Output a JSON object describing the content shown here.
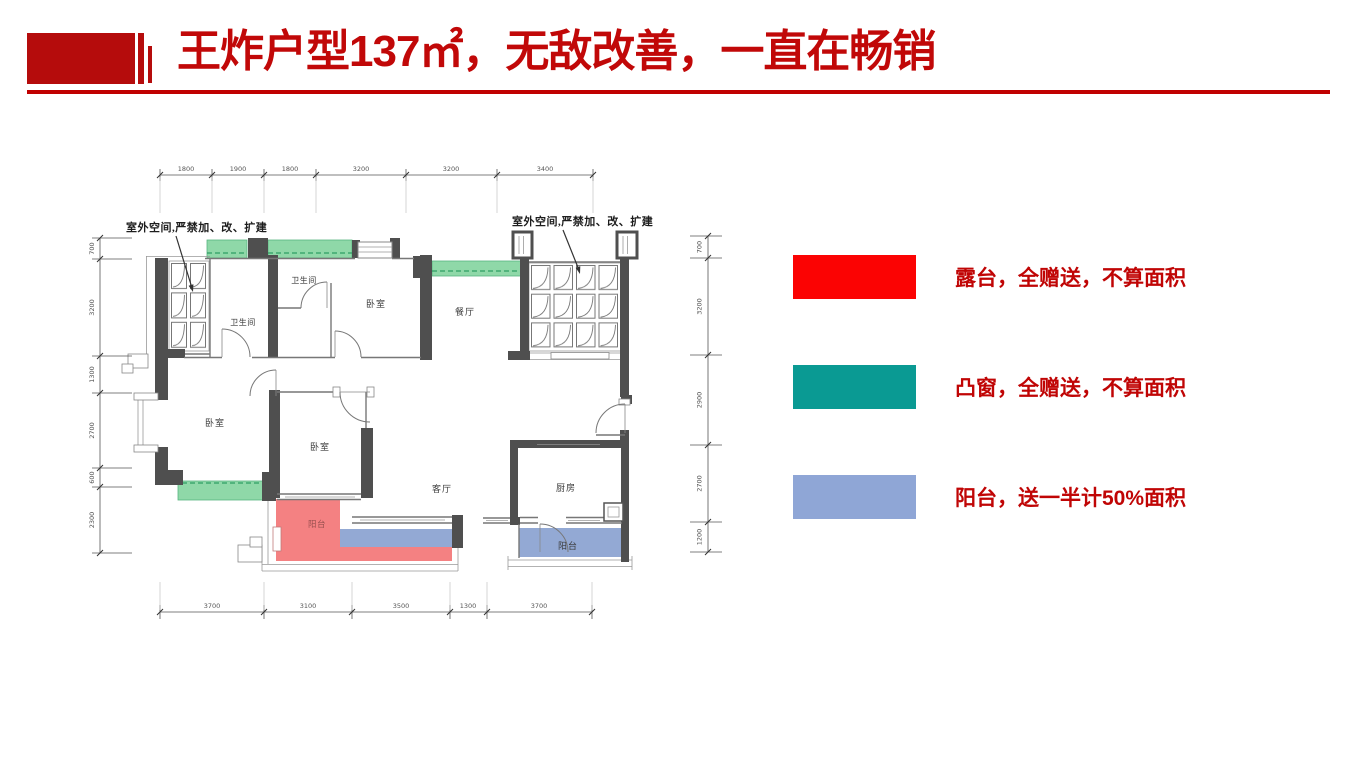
{
  "header": {
    "title": "王炸户型137㎡，无敌改善，一直在畅销",
    "accent_color": "#b50c0c",
    "title_color": "#c10808"
  },
  "legend": {
    "text_color": "#c00505",
    "items": [
      {
        "name": "terrace",
        "color": "#fb0303",
        "label": "露台，全赠送，不算面积"
      },
      {
        "name": "bay-window",
        "color": "#0a9a93",
        "label": "凸窗，全赠送，不算面积"
      },
      {
        "name": "balcony",
        "color": "#8fa6d6",
        "label": "阳台，送一半计50%面积"
      }
    ]
  },
  "plan": {
    "outdoor_note_left": "室外空间,严禁加、改、扩建",
    "outdoor_note_right": "室外空间,严禁加、改、扩建",
    "rooms": [
      {
        "label": "卫生间"
      },
      {
        "label": "卫生间"
      },
      {
        "label": "卧室"
      },
      {
        "label": "餐厅"
      },
      {
        "label": "卧室"
      },
      {
        "label": "卧室"
      },
      {
        "label": "客厅"
      },
      {
        "label": "厨房"
      },
      {
        "label": "阳台"
      },
      {
        "label": "阳台"
      }
    ],
    "dims_top": [
      "1800",
      "1900",
      "1800",
      "3200",
      "3200",
      "3400"
    ],
    "dims_bottom": [
      "3700",
      "3100",
      "3500",
      "1300",
      "3700"
    ],
    "dims_left": [
      "700",
      "3200",
      "1300",
      "2700",
      "600",
      "2300"
    ],
    "dims_right": [
      "700",
      "3200",
      "2900",
      "2700",
      "1200"
    ],
    "colors": {
      "terrace_fill": "#f48182",
      "bay_window_fill": "#8fd8a8",
      "balcony_fill": "#93a9d4",
      "wall": "#4f4f4f"
    }
  }
}
